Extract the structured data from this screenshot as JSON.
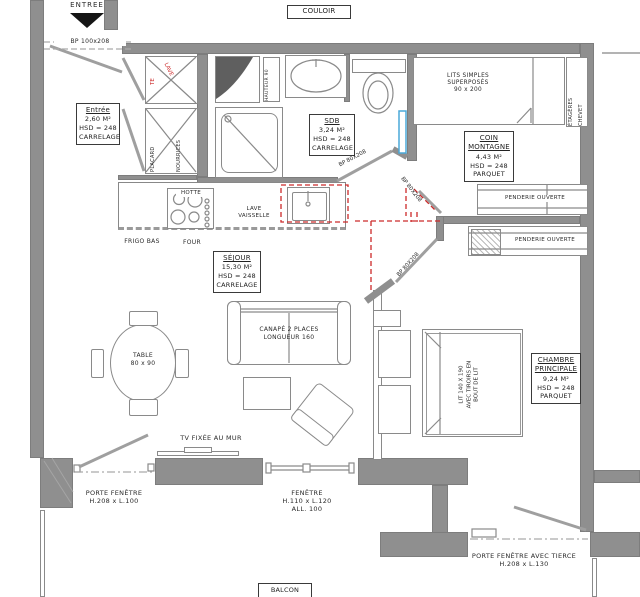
{
  "corridor_label": "COULOIR",
  "entrance": {
    "label": "ENTREE",
    "door": "BP 100x208"
  },
  "rooms": {
    "entree": {
      "name": "Entrée",
      "area": "2,60 M²",
      "hsd": "HSD = 248",
      "floor": "CARRELAGE"
    },
    "sdb": {
      "name": "SDB",
      "area": "3,24 M²",
      "hsd": "HSD = 248",
      "floor": "CARRELAGE"
    },
    "coin": {
      "name1": "COIN",
      "name2": "MONTAGNE",
      "area": "4,43 M²",
      "hsd": "HSD = 248",
      "floor": "PARQUET"
    },
    "sejour": {
      "name": "SÉJOUR",
      "area": "15,30 M²",
      "hsd": "HSD = 248",
      "floor": "CARRELAGE"
    },
    "chambre": {
      "name1": "CHAMBRE",
      "name2": "PRINCIPALE",
      "area": "9,24 M²",
      "hsd": "HSD = 248",
      "floor": "PARQUET"
    }
  },
  "doors": {
    "sdb": "BP 80X208",
    "coin": "BP 80X208",
    "chambre": "BP 80X208"
  },
  "storage": {
    "placard": "PLACARD",
    "nourrices": "NOURRICES",
    "red1": "TE",
    "red2": "LAVE",
    "penderie_coin": "PENDERIE OUVERTE",
    "penderie_chambre": "PENDERIE OUVERTE",
    "etageres": "ÉTAGÈRES",
    "chevet": "CHEVET",
    "hauteur": "HAUTEUR 90"
  },
  "kitchen": {
    "hotte": "HOTTE",
    "frigo_bas": "FRIGO BAS",
    "four": "FOUR",
    "lave": "LAVE",
    "vaisselle": "VAISSELLE"
  },
  "furniture": {
    "bunk1": "LITS SIMPLES",
    "bunk2": "SUPERPOSÉS",
    "bunk3": "90 x 200",
    "sofa1": "CANAPÉ 2 PLACES",
    "sofa2": "LONGUEUR 160",
    "table1": "TABLE",
    "table2": "80 x 90",
    "bed1": "LIT 140 X 190",
    "bed2": "AVEC TIROIRS EN",
    "bed3": "BOUT DE LIT",
    "tv": "TV FIXÉE AU MUR"
  },
  "openings": {
    "pf1": "PORTE FENÊTRE",
    "pf2": "H.208 x L.100",
    "win1": "FENÊTRE",
    "win2": "H.110 x L.120",
    "win3": "ALL. 100",
    "pft1": "PORTE FENÊTRE AVEC TIERCE",
    "pft2": "H.208 x L.130",
    "balcon": "BALCON"
  },
  "colors": {
    "wall": "#8f8f8f",
    "accent_red": "#cc2a2a",
    "accent_blue": "#4aa8d8"
  }
}
